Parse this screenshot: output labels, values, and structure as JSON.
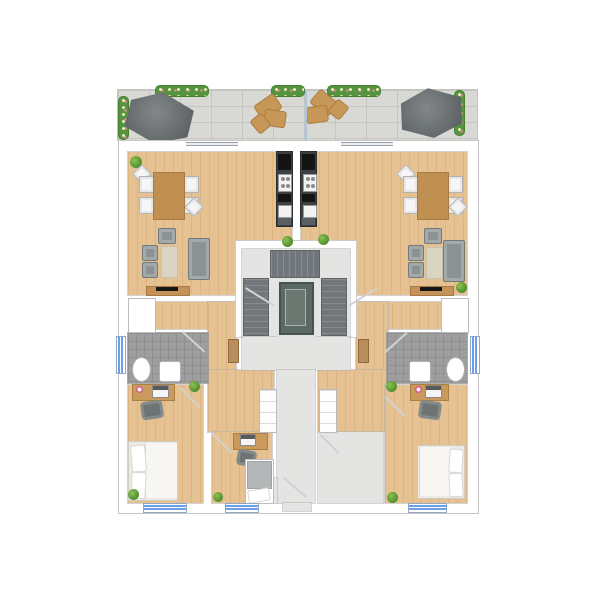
{
  "meta": {
    "title": "Residential floor plan – top-down view",
    "description": "Architectural color floor plan of one building level: two mirrored apartments around a central stairwell with elevator, shared entrance corridor, storage room and a shared roof terrace at the top.",
    "visible_text": [],
    "scale_px": {
      "width": 600,
      "height": 600
    }
  },
  "palette": {
    "background": "#ffffff",
    "wall_outline": "#c6c6c6",
    "wood_floor": "#e6c191",
    "hard_floor_gray": "#e4e4e3",
    "bathroom_tile": "#9e9e9e",
    "terrace_paving": "#d8d8d4",
    "planter_green": "#57943f",
    "parasol_gray": "#62676a",
    "terrace_wood_furniture": "#c79757",
    "terrace_divider_glass": "#a5c6e6",
    "window_glass_blue": "#6d9eeb",
    "kitchen_unit_dark": "#3c4043",
    "stair_tread": "#71767a",
    "elevator_car": "#5b6963",
    "sofa_gray": "#8c9191",
    "rug_beige": "#dad5c3",
    "dining_table_wood": "#c08f52",
    "chair_white": "#f6f6f6",
    "bed_linen_white": "#f7f6f2",
    "single_bed_blanket_gray": "#b3b7b7",
    "desk_wood": "#c99a5b",
    "office_chair_gray": "#6e7474",
    "lamp_pink": "#d9578a",
    "plant_green": "#4e8f2f",
    "entry_door_leaf": "#b98e5c",
    "tv_black": "#161616"
  },
  "terrace": {
    "name": "Shared roof terrace",
    "elements": [
      "stone paving grid",
      "flower planter boxes (5)",
      "parasol left",
      "parasol right",
      "wooden lounge group left",
      "wooden lounge group right",
      "glass privacy divider",
      "sliding glass door to left apartment",
      "sliding glass door to right apartment"
    ]
  },
  "apartment_left": {
    "name": "Left apartment",
    "living_dining_kitchen": {
      "name": "Open living / dining / kitchen",
      "furniture": [
        "kitchen unit with cooktop, oven and sink",
        "dining table with six chairs",
        "three-seat sofa",
        "two armchairs",
        "lounge chair",
        "rug",
        "TV sideboard",
        "potted plants (2)"
      ]
    },
    "hallway": {
      "name": "Hallway",
      "furniture": [
        "wardrobe"
      ],
      "doors": [
        "entry door from landing",
        "door to living room",
        "door to bathroom",
        "door to bedroom",
        "door to second room"
      ]
    },
    "bathroom": {
      "name": "Bathroom",
      "fixtures": [
        "shower",
        "toilet",
        "washbasin",
        "window on left facade"
      ]
    },
    "bedroom": {
      "name": "Bedroom",
      "furniture": [
        "double bed with two pillows",
        "desk with laptop and pink lamp",
        "office chair",
        "potted plants (2)",
        "window on bottom facade"
      ]
    },
    "second_room": {
      "name": "Second room / study",
      "furniture": [
        "single bed with gray blanket",
        "desk with laptop",
        "office chair",
        "potted plant",
        "window on bottom facade"
      ]
    }
  },
  "apartment_right": {
    "name": "Right apartment (mirrored)",
    "living_dining_kitchen": {
      "name": "Open living / dining / kitchen",
      "furniture": [
        "kitchen unit with cooktop, oven and sink",
        "dining table with six chairs",
        "three-seat sofa",
        "two armchairs",
        "lounge chair",
        "rug",
        "TV sideboard",
        "potted plants (2)"
      ]
    },
    "hallway": {
      "name": "Hallway",
      "furniture": [
        "wardrobe"
      ],
      "doors": [
        "entry door from landing",
        "door to living room",
        "door to bathroom",
        "door to bedroom"
      ]
    },
    "bathroom": {
      "name": "Bathroom",
      "fixtures": [
        "shower",
        "toilet",
        "washbasin",
        "window on right facade"
      ]
    },
    "bedroom": {
      "name": "Bedroom",
      "furniture": [
        "double bed with two pillows",
        "desk with laptop and pink lamp",
        "office chair",
        "potted plants (2)",
        "window on bottom facade"
      ]
    }
  },
  "common_areas": {
    "stairwell": {
      "name": "Stairwell",
      "elements": [
        "U-shaped staircase (three flights)",
        "elevator"
      ]
    },
    "landing": {
      "name": "Landing",
      "elements": [
        "entry door to left apartment",
        "entry door to right apartment"
      ]
    },
    "corridor": {
      "name": "Entrance corridor",
      "elements": [
        "building entrance door at bottom"
      ]
    },
    "storage": {
      "name": "Storage room",
      "elements": []
    }
  },
  "windows": {
    "bottom_facade": 3,
    "left_facade": 1,
    "right_facade": 1
  }
}
